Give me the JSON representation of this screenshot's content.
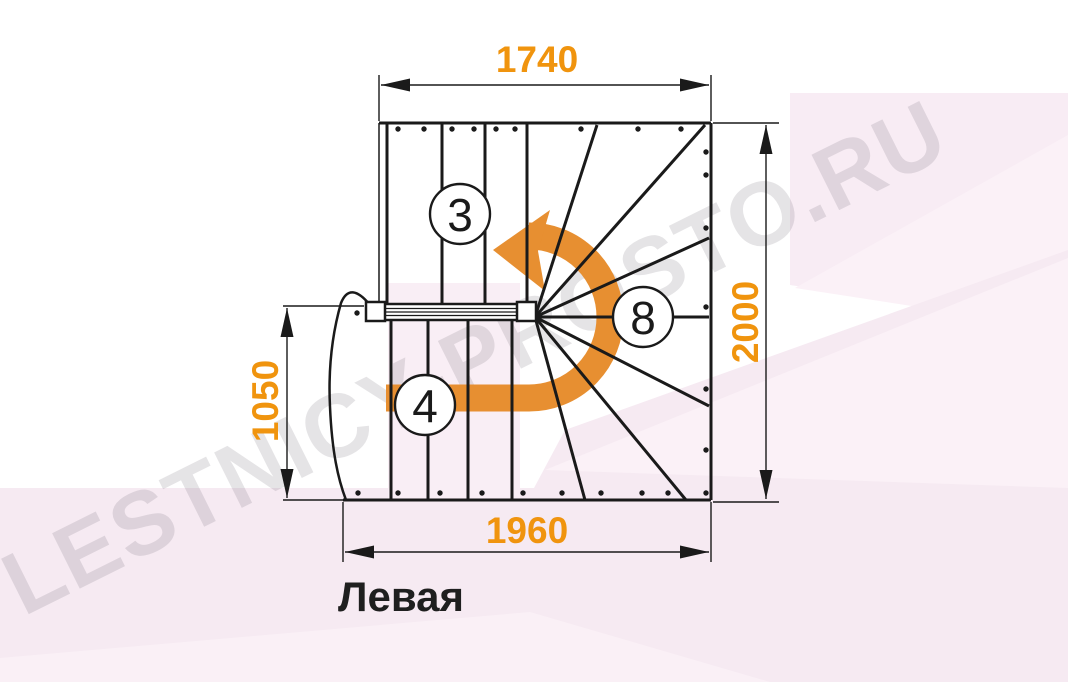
{
  "watermark": "LESTNICY-PROSTO.RU",
  "plan_label": "Левая",
  "dimensions": {
    "top": "1740",
    "right": "2000",
    "left": "1050",
    "bottom": "1960"
  },
  "step_counts": {
    "upper_flight": "3",
    "winder": "8",
    "lower_flight": "4"
  },
  "colors": {
    "dimension_text": "#F0940E",
    "turn_arrow": "#E78F31",
    "line": "#1A1A1A",
    "watermark_gray": "#E3E1E4",
    "background_tint": "#F6EAF2"
  },
  "icons": {
    "turn_arrow": "curved-turn-arrow-counterclockwise"
  }
}
